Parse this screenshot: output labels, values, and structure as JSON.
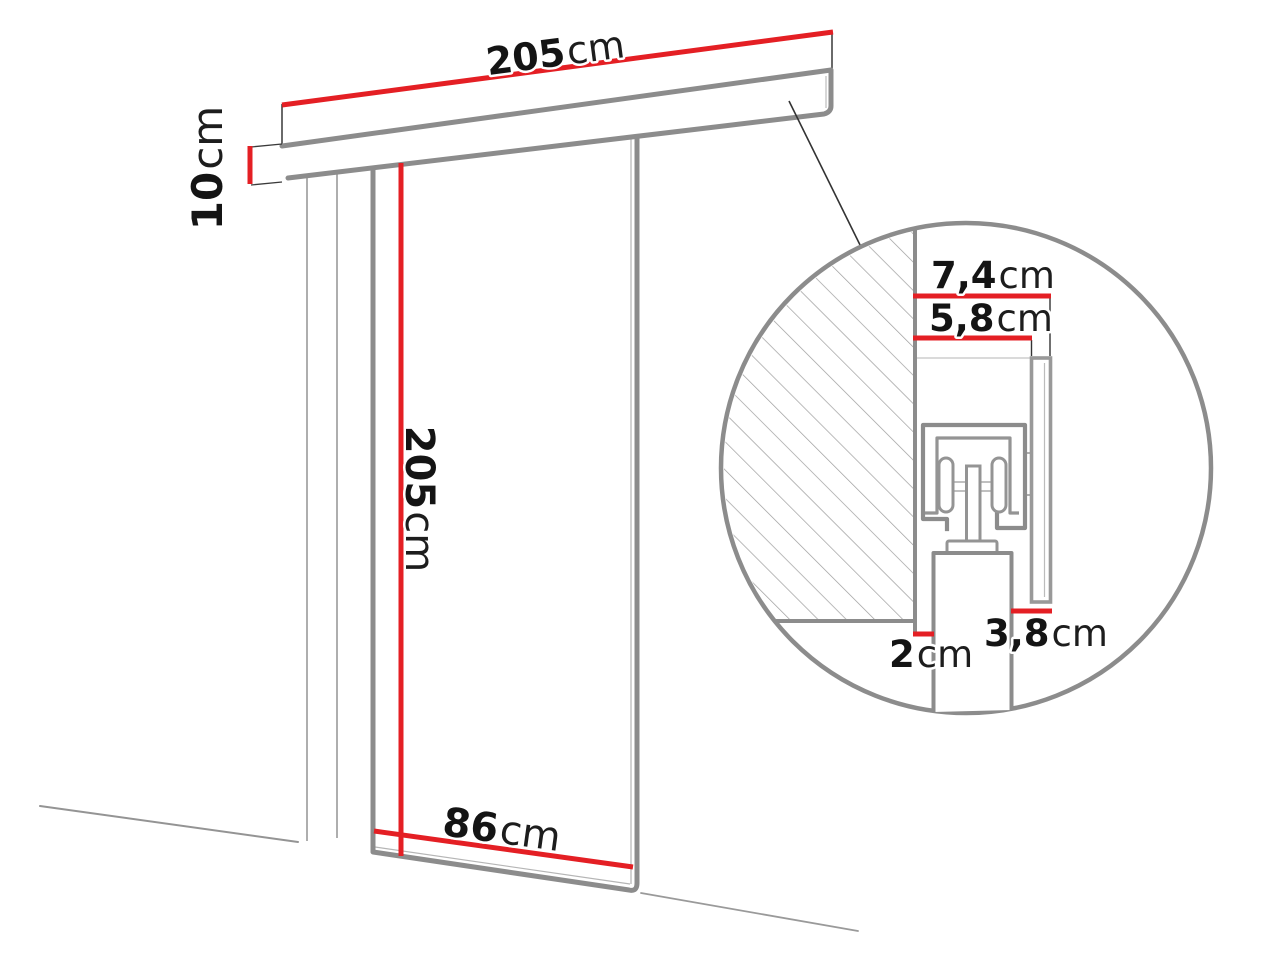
{
  "diagram_title": "sliding-door-system-technical-drawing",
  "labels": {
    "track_length": {
      "value": "205",
      "unit": "cm"
    },
    "track_height": {
      "value": "10",
      "unit": "cm"
    },
    "door_height": {
      "value": "205",
      "unit": "cm"
    },
    "door_width": {
      "value": "86",
      "unit": "cm"
    },
    "detail_total_depth": {
      "value": "7,4",
      "unit": "cm"
    },
    "detail_track_depth": {
      "value": "5,8",
      "unit": "cm"
    },
    "detail_wall_gap": {
      "value": "2",
      "unit": "cm"
    },
    "detail_door_offset": {
      "value": "3,8",
      "unit": "cm"
    }
  },
  "colors": {
    "dimension_red": "#e41f24",
    "structure_gray": "#8c8c8c",
    "light_gray": "#9a9a9a",
    "text_black": "#141414"
  }
}
